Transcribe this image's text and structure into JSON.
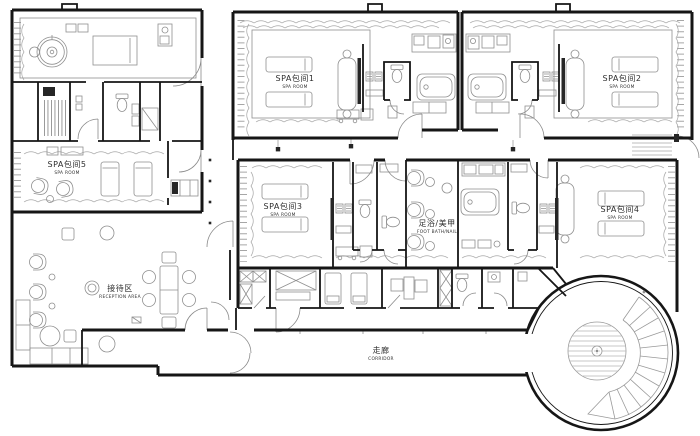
{
  "rooms": {
    "spa1": {
      "zh": "SPA包间1",
      "en": "SPA ROOM"
    },
    "spa2": {
      "zh": "SPA包间2",
      "en": "SPA ROOM"
    },
    "spa3": {
      "zh": "SPA包间3",
      "en": "SPA ROOM"
    },
    "spa4": {
      "zh": "SPA包间4",
      "en": "SPA ROOM"
    },
    "spa5": {
      "zh": "SPA包间5",
      "en": "SPA ROOM"
    },
    "footbath": {
      "zh": "足浴/美甲",
      "en": "FOOT BATH/NAIL"
    },
    "reception": {
      "zh": "接待区",
      "en": "RECEPTION AREA"
    },
    "corridor": {
      "zh": "走廊",
      "en": "CORRIDOR"
    }
  },
  "colors": {
    "wall": "#161616",
    "furniture": "#8f8f8f",
    "curtain": "#a6a6a6",
    "door": "#8a8a8a",
    "label": "#2e2e2e",
    "bg": "#ffffff"
  }
}
